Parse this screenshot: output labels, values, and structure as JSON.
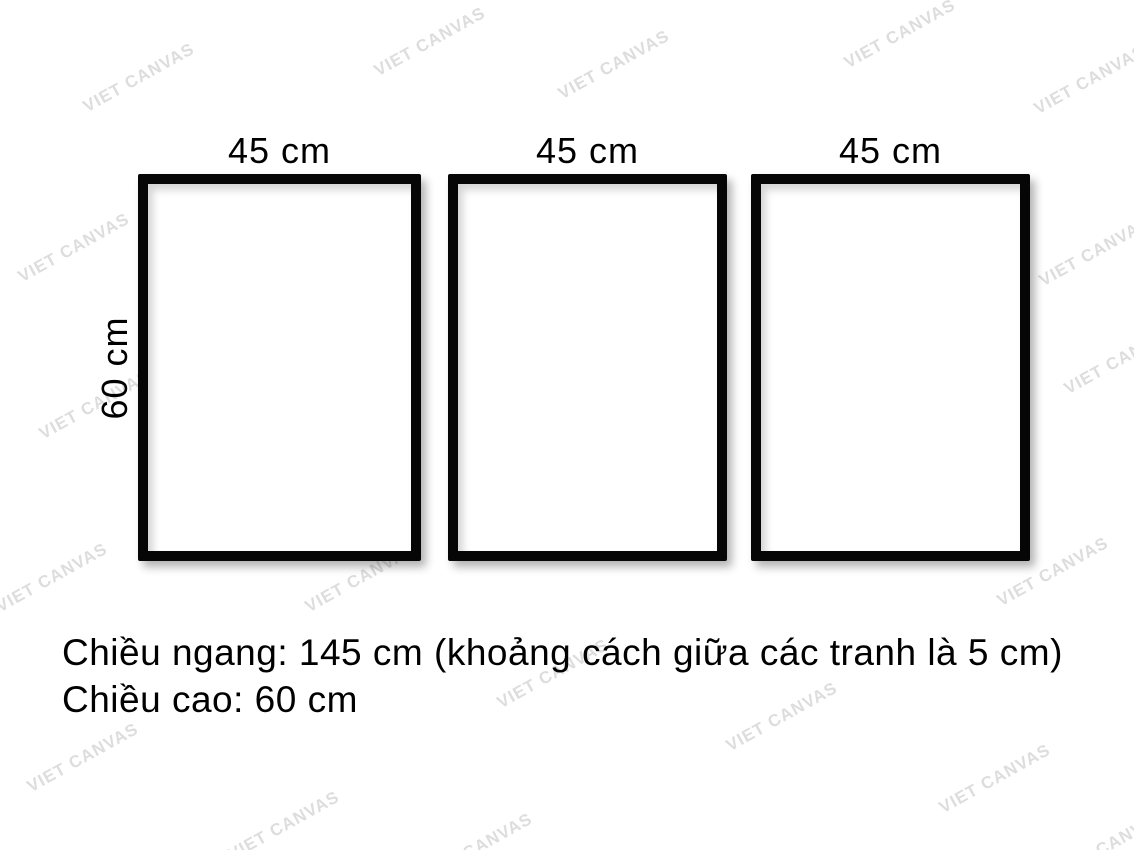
{
  "frames": [
    {
      "width_label": "45 cm"
    },
    {
      "width_label": "45 cm"
    },
    {
      "width_label": "45 cm"
    }
  ],
  "height_label": "60 cm",
  "caption": {
    "line1": "Chiều ngang: 145 cm (khoảng cách giữa các tranh là 5 cm)",
    "line2": "Chiều cao: 60 cm"
  },
  "watermark": {
    "text": "VIET CANVAS",
    "color": "#dddddd",
    "positions": [
      [
        139,
        78
      ],
      [
        430,
        42
      ],
      [
        614,
        65
      ],
      [
        900,
        34
      ],
      [
        1090,
        80
      ],
      [
        74,
        248
      ],
      [
        362,
        238
      ],
      [
        581,
        246
      ],
      [
        849,
        250
      ],
      [
        1095,
        252
      ],
      [
        95,
        405
      ],
      [
        290,
        435
      ],
      [
        575,
        428
      ],
      [
        1120,
        360
      ],
      [
        52,
        578
      ],
      [
        361,
        578
      ],
      [
        836,
        505
      ],
      [
        1053,
        572
      ],
      [
        553,
        674
      ],
      [
        83,
        758
      ],
      [
        782,
        717
      ],
      [
        995,
        779
      ],
      [
        284,
        826
      ],
      [
        477,
        848
      ],
      [
        1110,
        845
      ]
    ]
  }
}
